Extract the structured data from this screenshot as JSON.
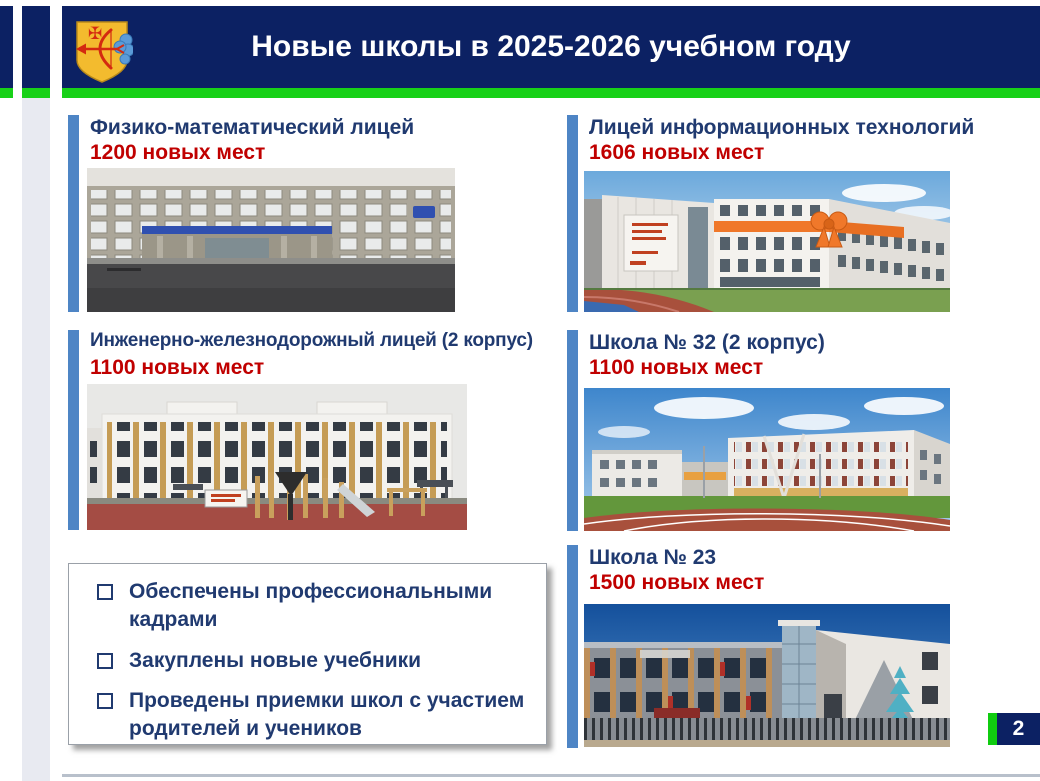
{
  "slide": {
    "title": "Новые школы в 2025-2026 учебном году",
    "page_number": "2"
  },
  "palette": {
    "header_navy": "#0c2163",
    "accent_green": "#18d118",
    "accent_bar_blue": "#4e85c5",
    "school_name_blue": "#203a70",
    "places_red": "#c00000"
  },
  "emblem": "kirov-oblast-coat-of-arms",
  "schools": [
    {
      "name": "Физико-математический лицей",
      "places": "1200 новых мест"
    },
    {
      "name": "Лицей информационных технологий",
      "places": "1606 новых мест"
    },
    {
      "name": "Инженерно-железнодорожный лицей (2 корпус)",
      "places": "1100 новых мест"
    },
    {
      "name": "Школа № 32 (2 корпус)",
      "places": "1100 новых мест"
    },
    {
      "name": "Школа № 23",
      "places": "1500 новых мест"
    }
  ],
  "checklist": {
    "items": [
      "Обеспечены профессиональными кадрами",
      "Закуплены новые учебники",
      "Проведены приемки школ с участием родителей и учеников"
    ]
  }
}
